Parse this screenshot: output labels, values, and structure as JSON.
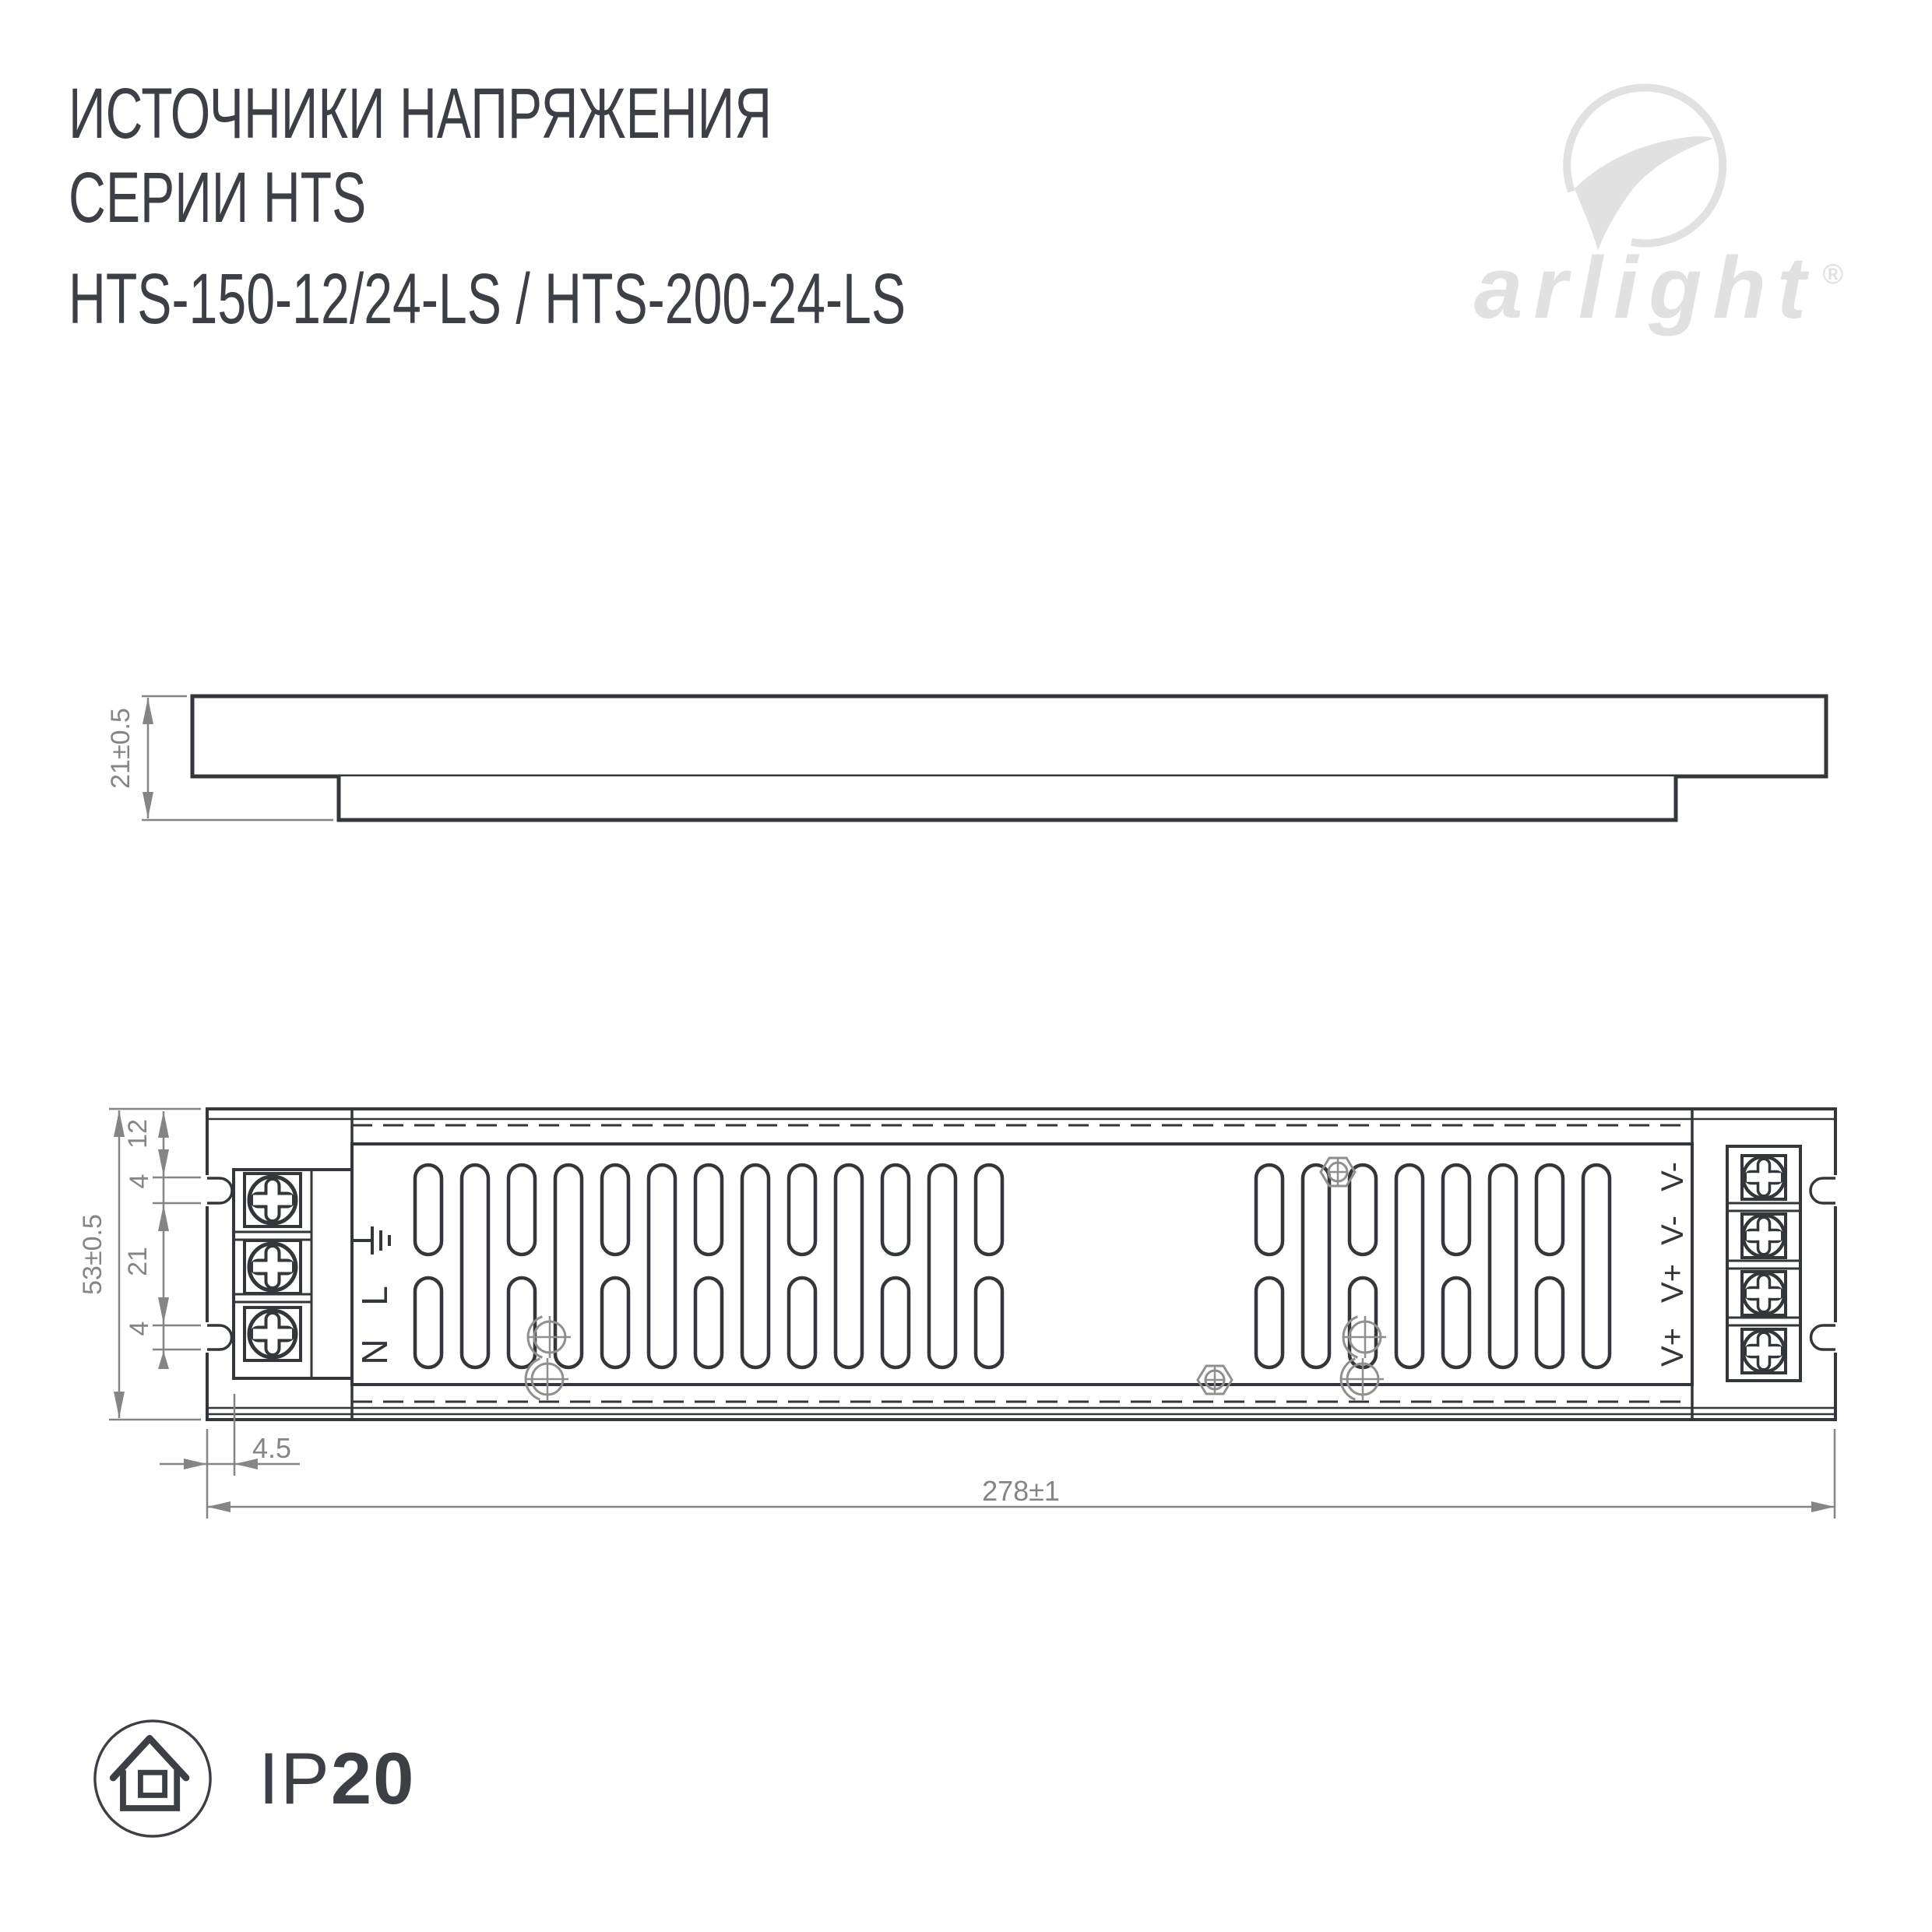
{
  "header": {
    "line1": "ИСТОЧНИКИ НАПРЯЖЕНИЯ",
    "line2": "СЕРИИ HTS",
    "line3": "HTS-150-12/24-LS / HTS-200-24-LS"
  },
  "logo": {
    "wordmark": "arlight",
    "registered": "®"
  },
  "drawings": {
    "side_view": {
      "height_dim": "21±0.5"
    },
    "top_view": {
      "height_dim": "53±0.5",
      "chain_dims": [
        "12",
        "4",
        "21",
        "4"
      ],
      "offset_dim": "4.5",
      "length_dim": "278±1",
      "input_labels": [
        "L",
        "N"
      ],
      "output_labels": [
        "V-",
        "V-",
        "V+",
        "V+"
      ]
    }
  },
  "footer": {
    "protection_prefix": "IP",
    "protection_value": "20"
  },
  "colors": {
    "line": "#33363a",
    "dim": "#858585",
    "text": "#3c3f45",
    "logo": "#e1e1e2"
  }
}
